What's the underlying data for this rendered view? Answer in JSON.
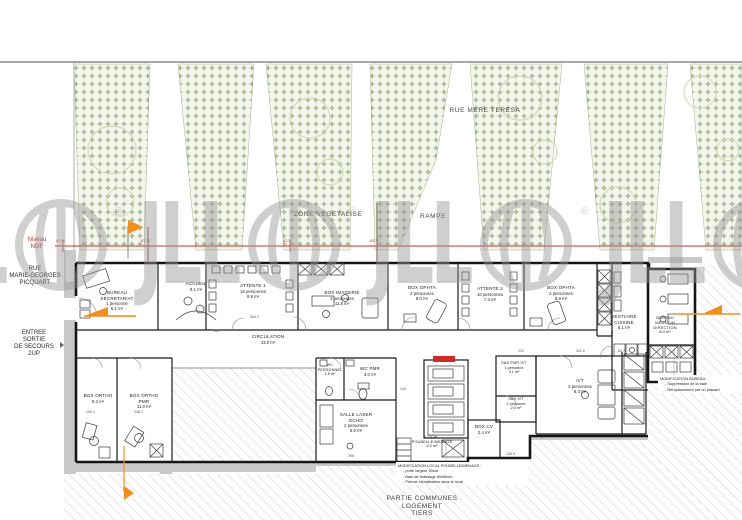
{
  "streets": {
    "top": "RUE MERE TERESA",
    "left1": "RUE",
    "left2": "MARIE-GEORGES",
    "left3": "PICQUART"
  },
  "site": {
    "zone_vegetalise": "ZONE VEGETALISE",
    "rampe": "RAMPE",
    "niveau": "Niveau",
    "ngf": "NGF",
    "entree1": "ENTREE",
    "entree2": "SORTIE",
    "entree3": "DE SECOURS",
    "entree4": "2UP",
    "partie1": "PARTIE COMMUNES",
    "partie2": "LOGEMENT",
    "partie3": "TIERS"
  },
  "levels": [
    "64.26",
    "63.72",
    "63.71",
    "63.77"
  ],
  "watermark": {
    "text": "JLL",
    "reg": "®"
  },
  "rooms": {
    "bureau_secretariat": {
      "name": "BUREAU SECRETARIAT",
      "capacity": "1 personne",
      "area": "6.1 m²"
    },
    "accueil": {
      "name": "ACCUEIL",
      "area": "9.1 m²"
    },
    "attente1": {
      "name": "ATTENTE 1",
      "capacity": "15 personnes",
      "area": "9.9 m²"
    },
    "box_imagerie": {
      "name": "BOX IMAGERIE",
      "capacity": "2 personnes",
      "area": "11.8 m²"
    },
    "box_ophta1": {
      "name": "BOX OPHTA",
      "capacity": "2 personnes",
      "area": "8.0 m²"
    },
    "attente2": {
      "name": "ATTENTE 2",
      "capacity": "10 personnes",
      "area": "7.4 m²"
    },
    "box_ophta2": {
      "name": "BOX OPHTA",
      "capacity": "2 personnes",
      "area": "8.9 m²"
    },
    "vestiaire_cuisine": {
      "name": "VESTIAIRE CUISINE",
      "area": "8.1 m²"
    },
    "bureau_medecin": {
      "name": "BUREAU MEDECIN DIRECTION",
      "area": "8.0 m²"
    },
    "circulation": {
      "name": "CIRCULATION",
      "area": "43.0 m²"
    },
    "box_ortho": {
      "name": "BOX ORTHO",
      "area": "8.2 m²"
    },
    "box_ortho_pmr": {
      "name": "BOX ORTHO PMR",
      "area": "11.0 m²"
    },
    "wc_personnel": {
      "name": "WC PERSONNEL",
      "area": "1.6 m²"
    },
    "wc_pmr": {
      "name": "WC PMR",
      "area": "3.0 m²"
    },
    "salle_laser_echo": {
      "name": "SALLE LASER ECHO",
      "capacity": "2 personnes",
      "area": "6.9 m²"
    },
    "local_poubelle": {
      "name": "LOCAL POUBELLE/MENAGE",
      "area": "4.2 m²"
    },
    "box_cv": {
      "name": "BOX CV",
      "area": "2.4 m²"
    },
    "sas_pmr_ivt": {
      "name": "SAS PMR IVT",
      "capacity": "1 personne",
      "area": "3.1 m²"
    },
    "sas_ivt": {
      "name": "SAS IVT",
      "capacity": "1 personne",
      "area": "2.0 m²"
    },
    "ivt": {
      "name": "IVT",
      "capacity": "2 personnes",
      "area": "8.3 m²"
    }
  },
  "notes": {
    "bureau": {
      "title": "MODIFICATION BUREAU :",
      "b1": "-  Suppression de la baie",
      "b2": "-  Remplacement par un placard"
    },
    "local": {
      "title": "MODIFICATION LOCAL POUBELLE/MENAGE :",
      "b1": "-  porte largeur 90cm",
      "b2": "-  Baie de brassage 60x60cm",
      "b3": "-  Prévoir climatisation dans le local"
    }
  },
  "dimensions": [
    "337",
    "364.1",
    "194.1",
    "246.1",
    "298",
    "140",
    "311.6",
    "84.7",
    "224",
    "126.5"
  ]
}
